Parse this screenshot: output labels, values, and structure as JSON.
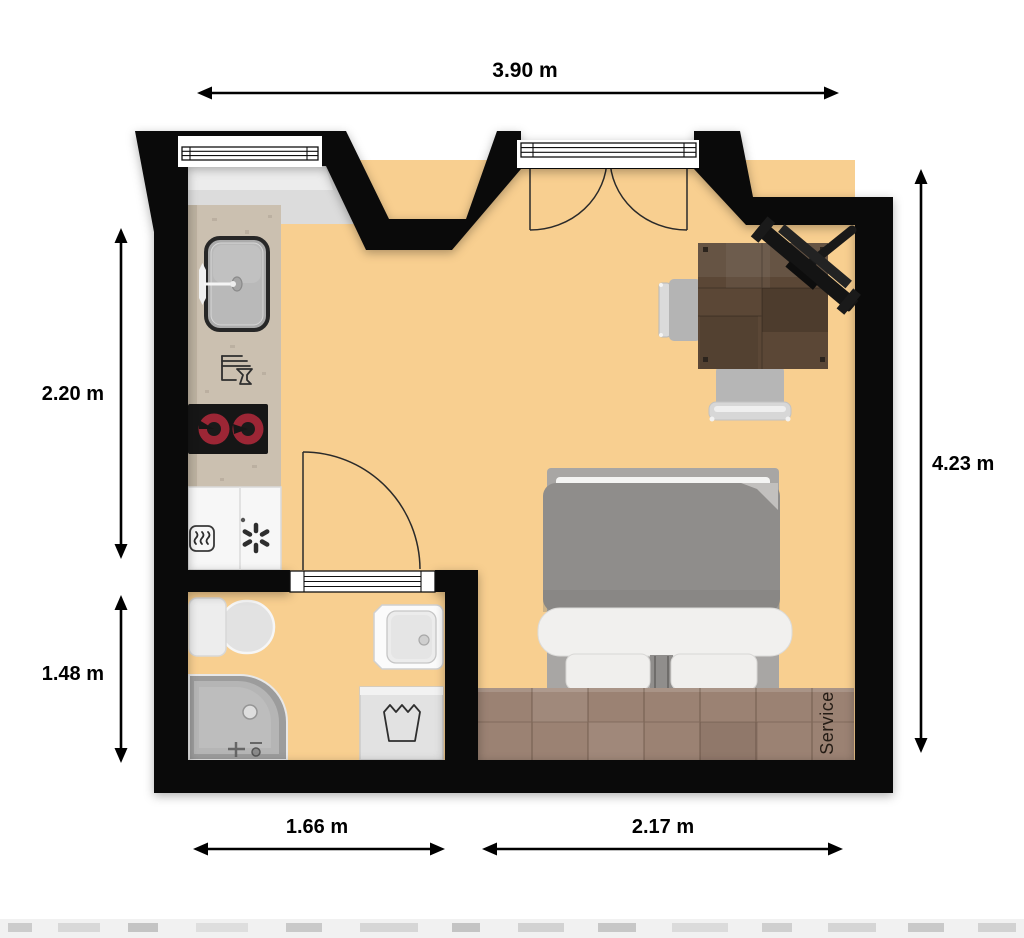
{
  "plan": {
    "dimensions": {
      "top": "3.90 m",
      "right": "4.23 m",
      "left_upper": "2.20 m",
      "left_lower": "1.48 m",
      "bottom_left": "1.66 m",
      "bottom_right": "2.17 m"
    },
    "labels": {
      "service_area": "Service"
    },
    "furniture": [
      "window",
      "balcony-french-door",
      "kitchen-counter",
      "kitchen-sink",
      "dishwasher-icon",
      "cooktop",
      "fridge-freezer",
      "heat-icon",
      "snowflake-icon",
      "interior-door",
      "toilet",
      "shower",
      "washbasin",
      "washing-machine",
      "double-bed",
      "pillows",
      "desk",
      "desk-chair",
      "side-chair",
      "corner-tv",
      "service-platform"
    ],
    "colors": {
      "wall": "#0a0a0a",
      "floor": "#f8cf90",
      "floor_bare": "#dcdcdc",
      "window_sill": "#ececec",
      "counter": "#cbc0b0",
      "burner": "#9c2635",
      "wood_platform": "#9b8273",
      "desk_wood": "#5b4736",
      "bed_duvet": "#8f8d8b",
      "bed_linen": "#f1f0ee",
      "appliance_white": "#f7f7f7",
      "fixture_gray": "#b5b5b5",
      "dimension_text": "#000000"
    }
  }
}
